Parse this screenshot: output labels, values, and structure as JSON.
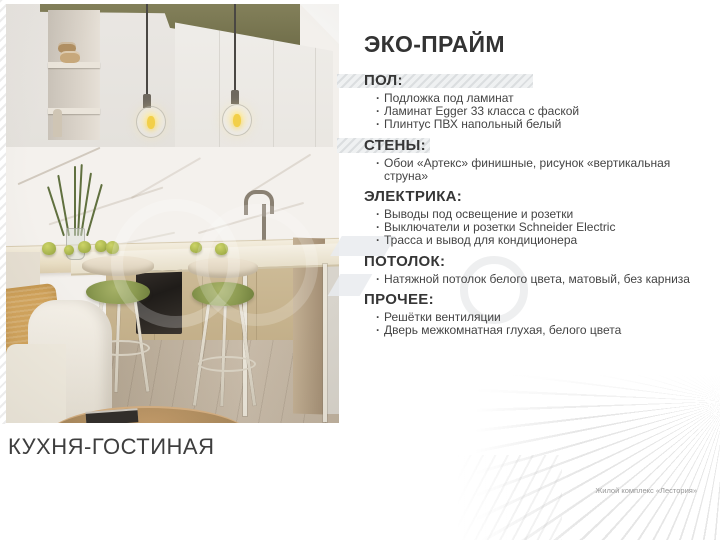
{
  "title": "ЭКО-ПРАЙМ",
  "caption": "КУХНЯ-ГОСТИНАЯ",
  "footer": "Жилой комплекс «Лестория»",
  "sections": [
    {
      "heading": "ПОЛ:",
      "items": [
        "Подложка под ламинат",
        "Ламинат Egger 33 класса с фаской",
        "Плинтус ПВХ напольный белый"
      ]
    },
    {
      "heading": "СТЕНЫ:",
      "items": [
        "Обои «Артекс» финишные, рисунок «вертикальная струна»"
      ]
    },
    {
      "heading": "ЭЛЕКТРИКА:",
      "items": [
        "Выводы под освещение и розетки",
        "Выключатели и розетки Schneider Electric",
        "Трасса и вывод  для кондиционера"
      ]
    },
    {
      "heading": "ПОТОЛОК:",
      "items": [
        "Натяжной потолок белого цвета, матовый, без карниза"
      ]
    },
    {
      "heading": "ПРОЧЕЕ:",
      "items": [
        "Решётки вентиляции",
        "Дверь межкомнатная глухая, белого цвета"
      ]
    }
  ],
  "photo": {
    "subject": "кухня-гостиная, рендер интерьера",
    "colors": {
      "wall_accent_olive": "#7c7a52",
      "cabinet_white": "#e9e6e2",
      "marble_wall": "#f4f1ed",
      "counter_wood": "#e8ddc3",
      "stool_cushion_green": "#8a9950",
      "pillow_mustard": "#d2a45c",
      "floor_wood": "#bdafa0",
      "oven_black": "#2a2521"
    }
  },
  "colors": {
    "text_dark": "#363636",
    "text_body": "#444444",
    "footer_gray": "#989898",
    "highlight_bar": "#edeff1"
  }
}
